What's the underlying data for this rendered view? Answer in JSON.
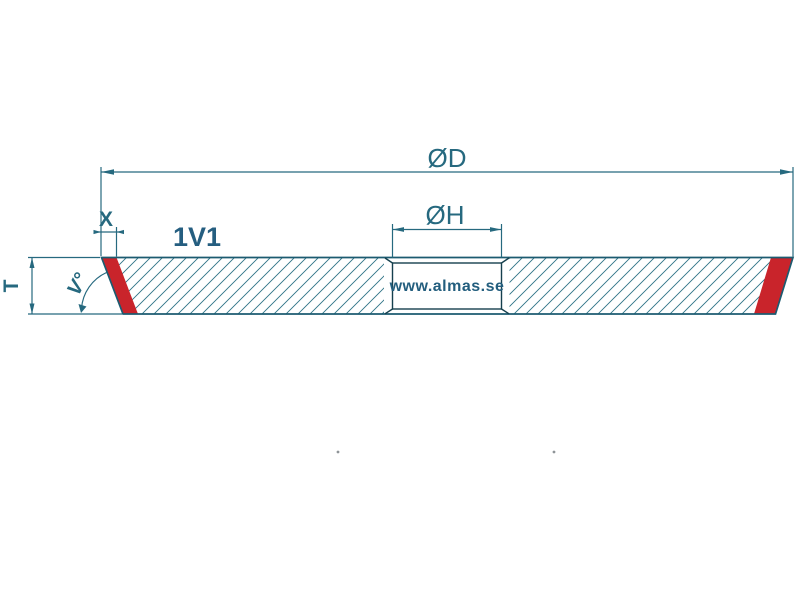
{
  "drawing": {
    "type_label": "1V1",
    "watermark": "www.almas.se",
    "dimensions": {
      "outer_diameter": "ØD",
      "hole_diameter": "ØH",
      "edge_width": "X",
      "thickness": "T",
      "angle": "V°"
    },
    "colors": {
      "line": "#26697F",
      "outline": "#1C5B70",
      "hatch": "#2E7386",
      "red_accent": "#C9242B",
      "label": "#255E80",
      "bore_line": "#16404E",
      "background": "#FFFFFF"
    }
  }
}
